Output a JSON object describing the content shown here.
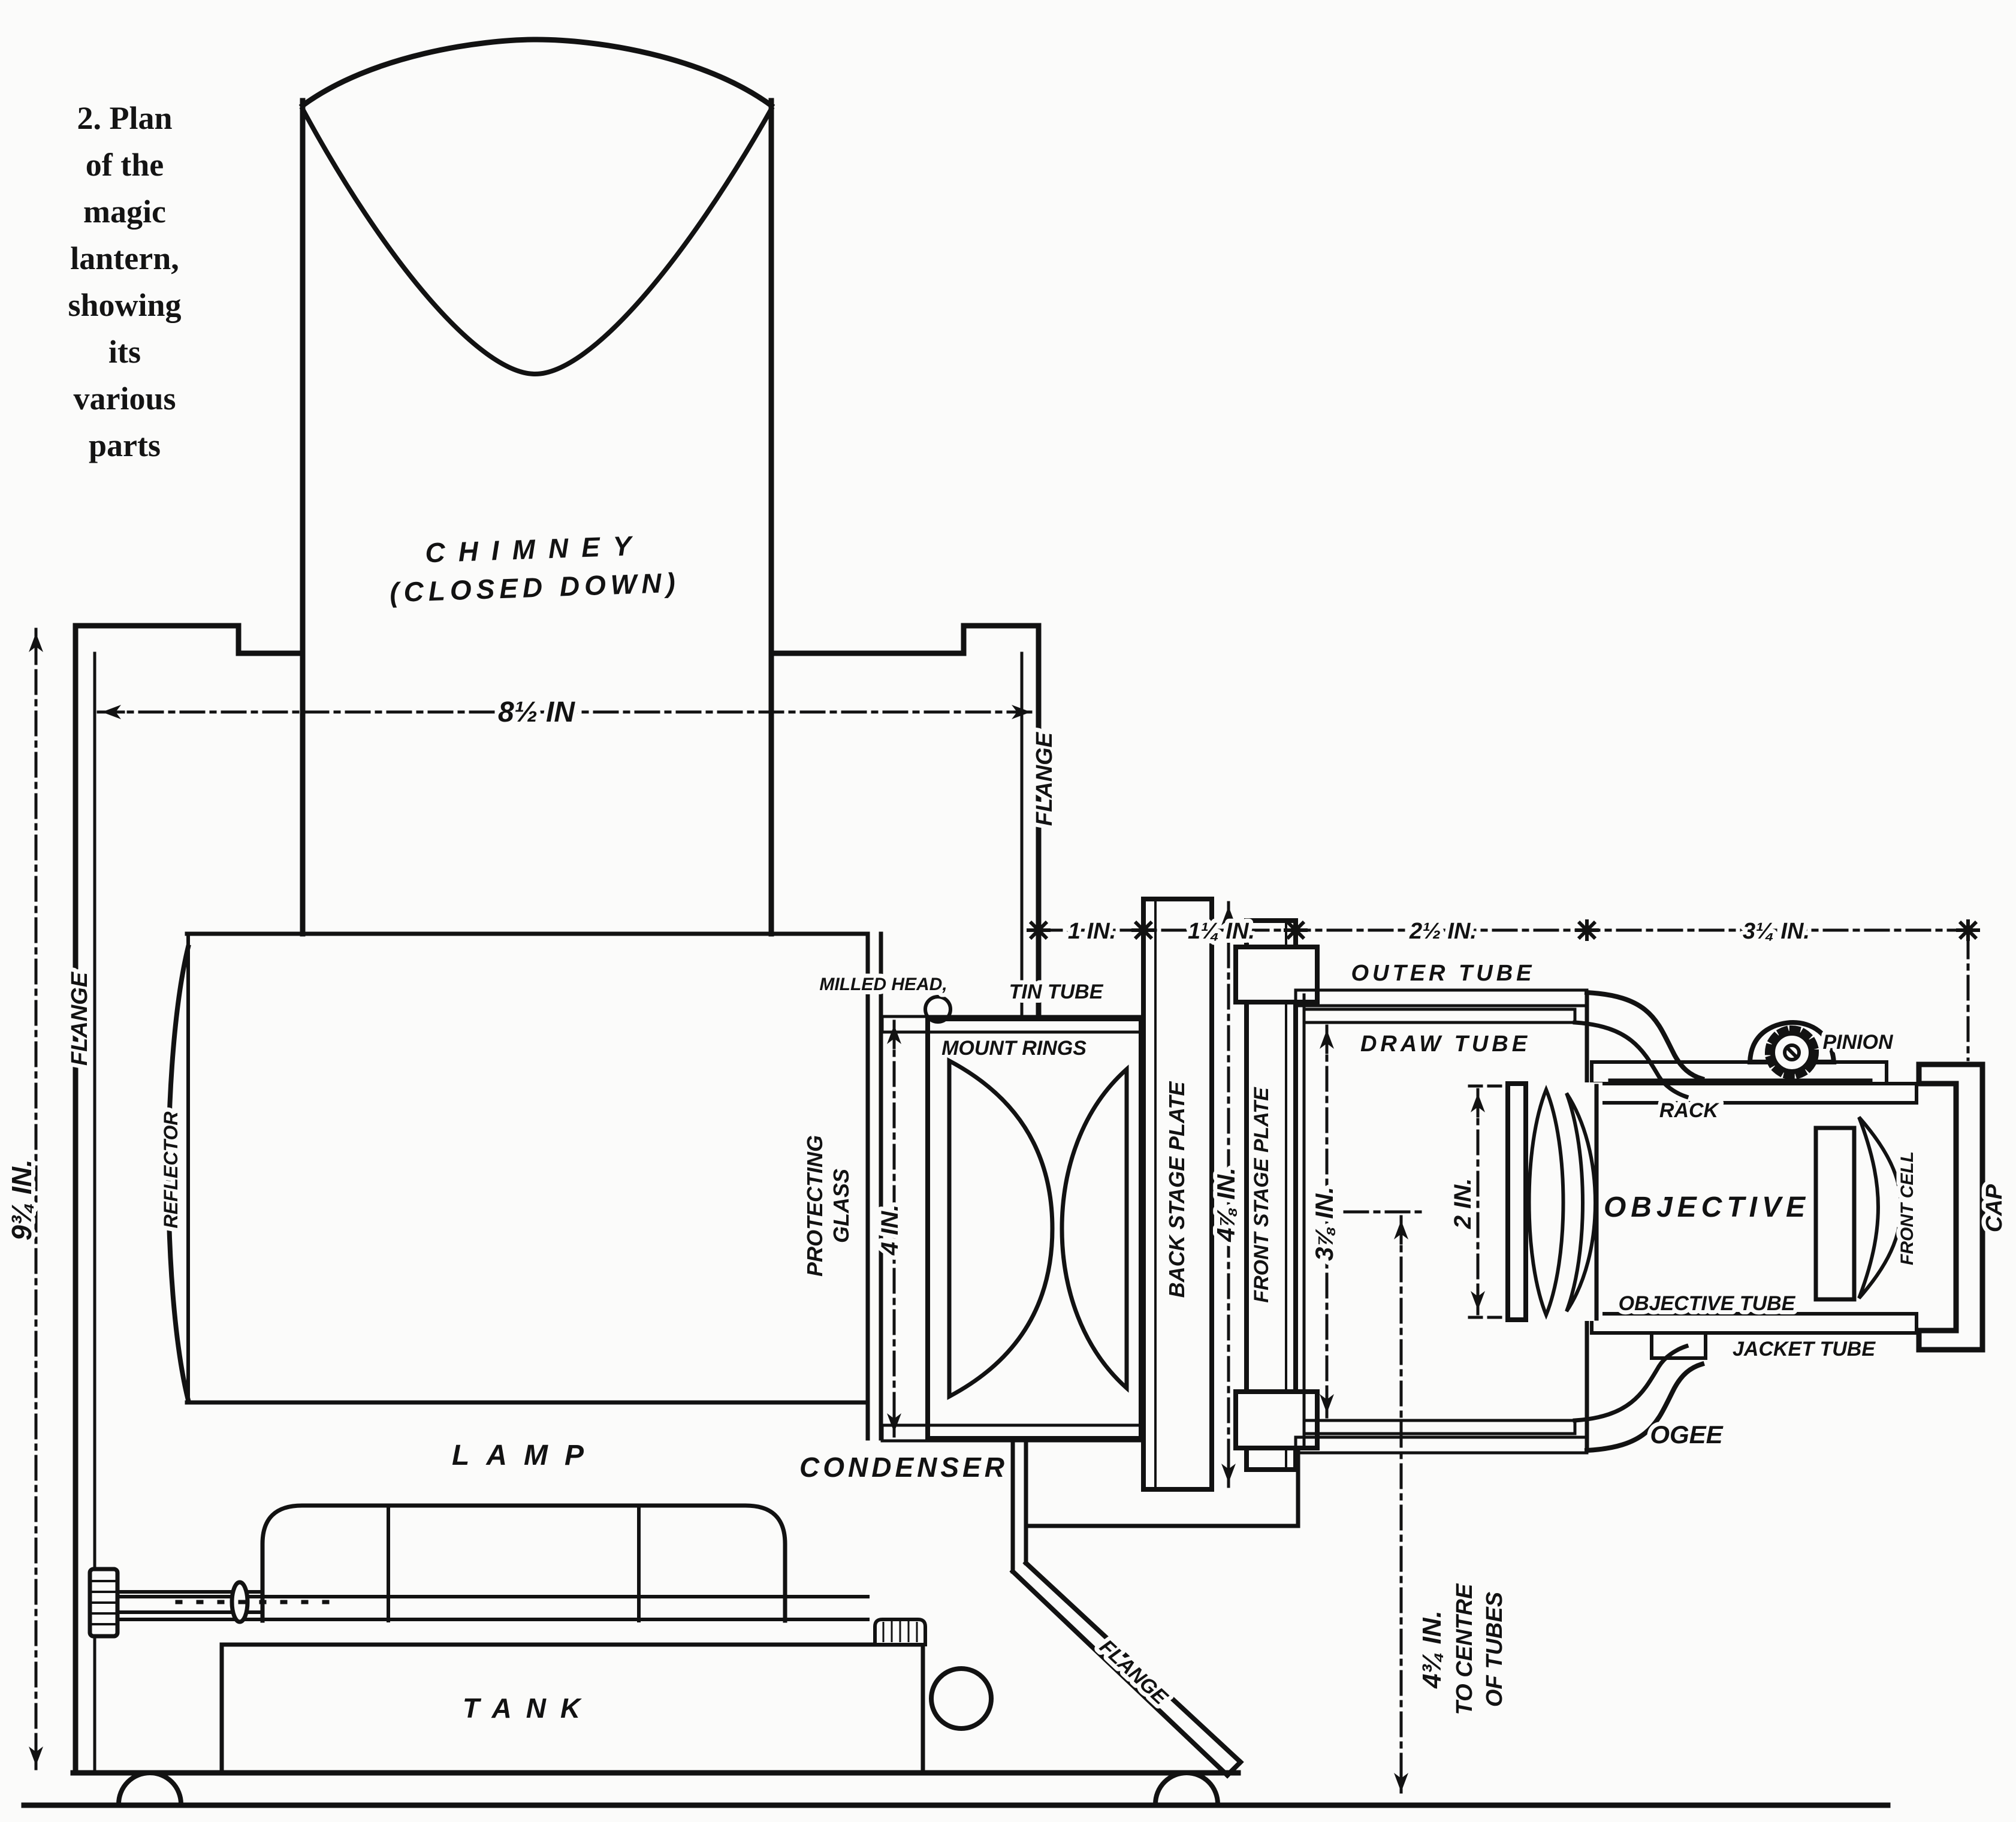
{
  "caption": {
    "lines": [
      "2. Plan",
      "of the",
      "magic",
      "lantern,",
      "showing",
      "its",
      "various",
      "parts"
    ]
  },
  "labels": {
    "chimney_1": "CHIMNEY",
    "chimney_2": "(CLOSED DOWN)",
    "flange_left": "FLANGE",
    "flange_right": "FLANGE",
    "flange_foot": "FLANGE",
    "reflector": "REFLECTOR",
    "lamp": "LAMP",
    "tank": "TANK",
    "protecting_1": "PROTECTING",
    "protecting_2": "GLASS",
    "condenser": "CONDENSER",
    "milled_head": "MILLED HEAD,",
    "tin_tube": "TIN TUBE",
    "mount_rings": "MOUNT RINGS",
    "back_stage_plate": "BACK STAGE PLATE",
    "front_stage_plate": "FRONT STAGE PLATE",
    "outer_tube": "OUTER TUBE",
    "draw_tube": "DRAW TUBE",
    "ogee": "OGEE",
    "rack": "RACK",
    "pinion": "PINION",
    "objective": "OBJECTIVE",
    "objective_tube": "OBJECTIVE TUBE",
    "jacket_tube": "JACKET TUBE",
    "front_cell": "FRONT CELL",
    "cap": "CAP"
  },
  "dimensions": {
    "body_width": "8½ IN",
    "body_height": "9¾ IN.",
    "condenser_diameter": "4 IN.",
    "stage_back_height": "4⅞ IN.",
    "draw_tube_diameter": "3⅞ IN.",
    "seg_flange_to_back_plate": "1 IN.",
    "seg_stage_plates": "1¼ IN.",
    "seg_outer_tube": "2½ IN.",
    "seg_objective": "3¼ IN.",
    "objective_diameter": "2 IN.",
    "centre_1": "4¾ IN.",
    "centre_2": "TO CENTRE",
    "centre_3": "OF TUBES"
  }
}
